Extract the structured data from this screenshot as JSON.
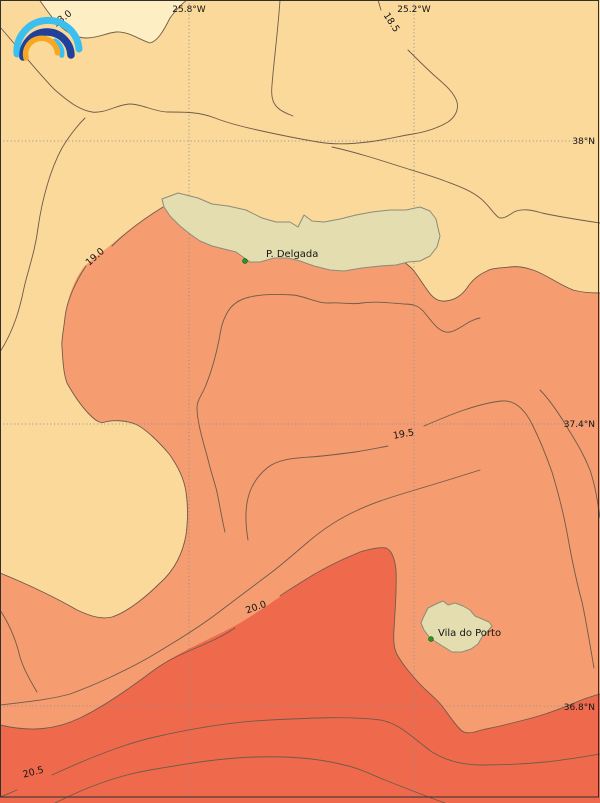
{
  "map": {
    "longitudes": [
      "25.8°W",
      "25.2°W"
    ],
    "latitudes": [
      "38°N",
      "37.4°N",
      "36.8°N"
    ],
    "isotherms": [
      "18.0",
      "18.5",
      "19.0",
      "19.5",
      "20.0",
      "20.5"
    ],
    "places": [
      {
        "name": "P. Delgada"
      },
      {
        "name": "Vila do Porto"
      }
    ],
    "colors": {
      "band_below_18": "#FDEEC3",
      "band_18_to_19": "#FBD99B",
      "band_19_to_20": "#F59C70",
      "band_above_20": "#EF6A4D",
      "land": "#E3DDB0",
      "contour_line": "#6F5B49",
      "grid_line": "#8F8F8F",
      "place_marker": "#1E9E1E",
      "frame": "#2F2F2F",
      "logo_cyan": "#3ABFEF",
      "logo_blue": "#20409A",
      "logo_orange": "#F7A823"
    }
  }
}
